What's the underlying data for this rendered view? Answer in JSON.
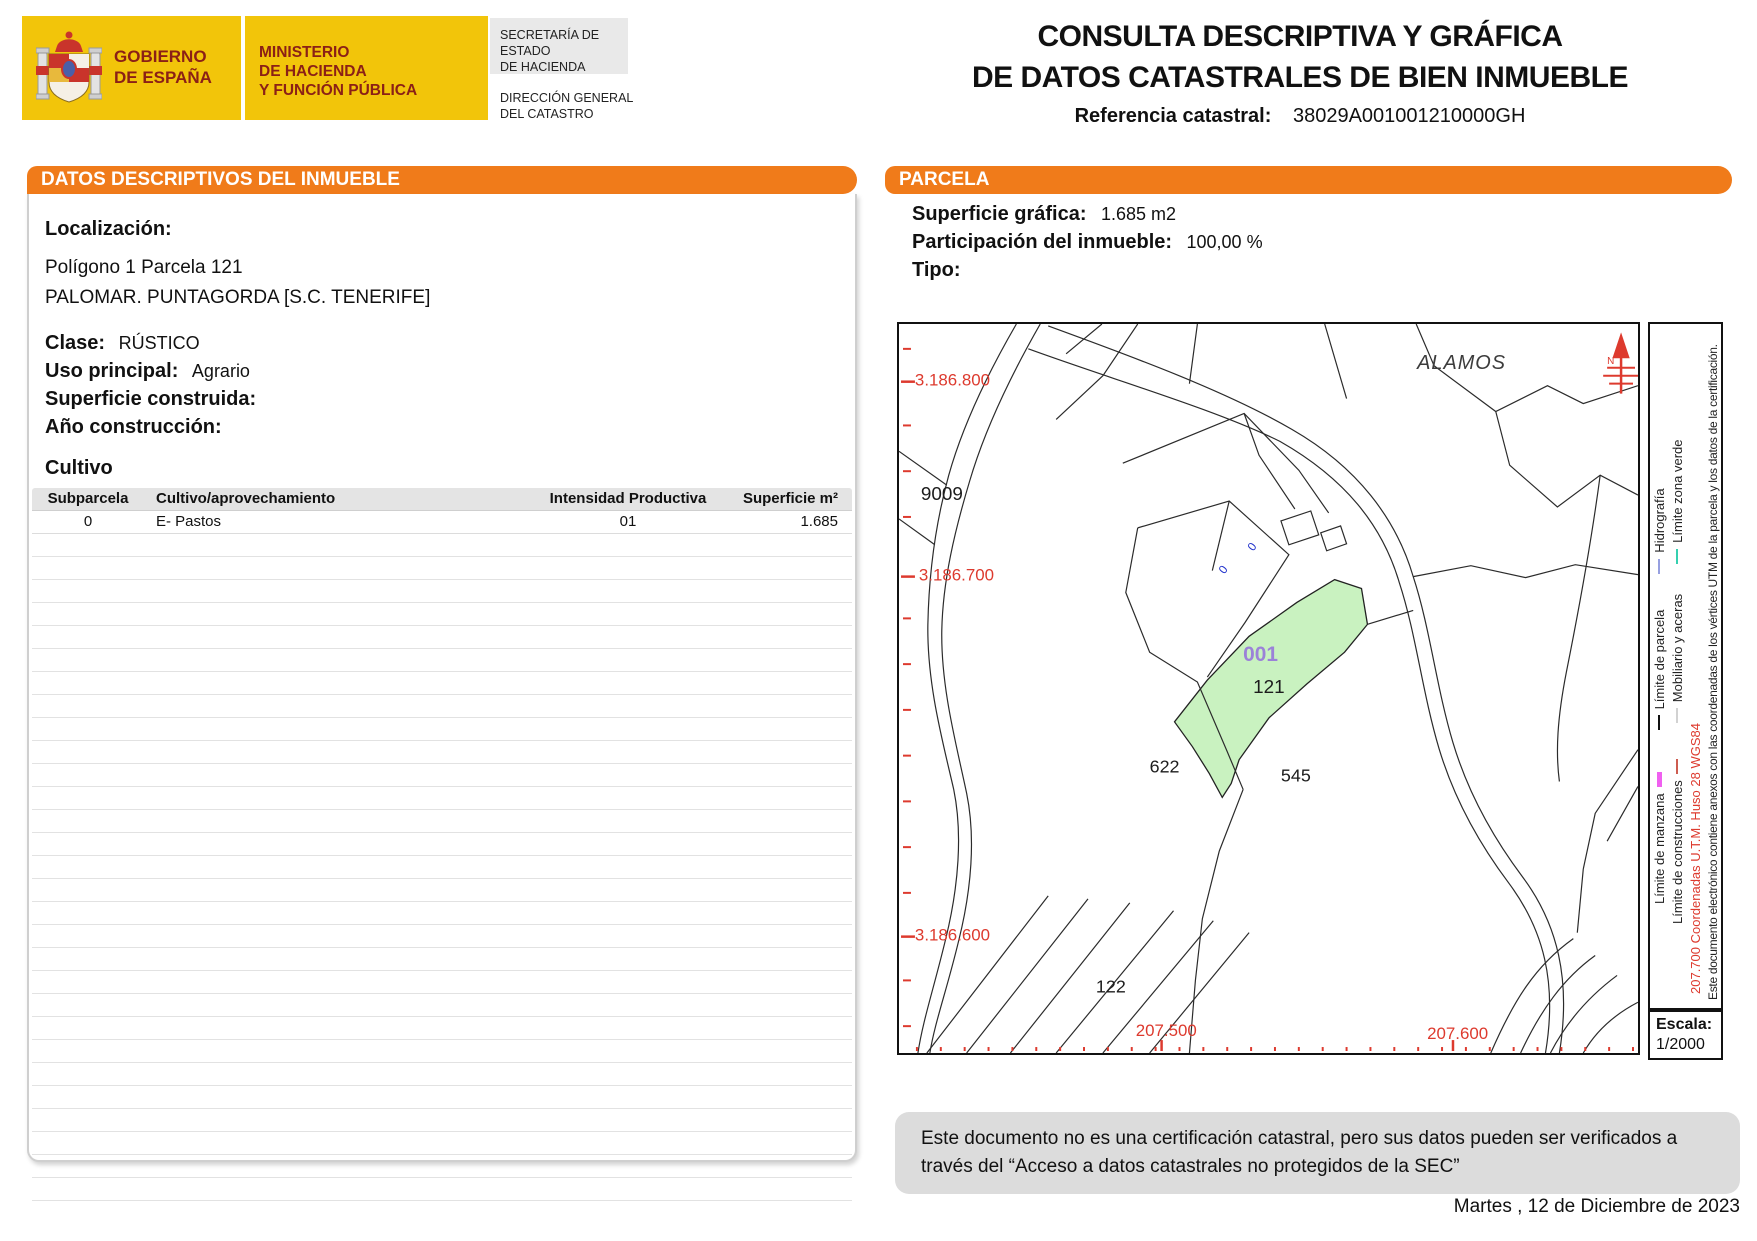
{
  "header": {
    "gobierno_lines": [
      "GOBIERNO",
      "DE ESPAÑA"
    ],
    "ministerio_lines": [
      "MINISTERIO",
      "DE HACIENDA",
      "Y FUNCIÓN PÚBLICA"
    ],
    "secretaria_lines": [
      "SECRETARÍA DE ESTADO",
      "DE HACIENDA"
    ],
    "direccion_lines": [
      "DIRECCIÓN GENERAL",
      "DEL CATASTRO"
    ],
    "title_line1": "CONSULTA DESCRIPTIVA Y GRÁFICA",
    "title_line2": "DE DATOS CATASTRALES DE BIEN INMUEBLE",
    "ref_label": "Referencia catastral:",
    "ref_value": "38029A001001210000GH"
  },
  "left_panel": {
    "section_title_prefix": "DATOS DESCRIPTIVOS DEL ",
    "section_title_bold": "INMUEBLE",
    "localizacion_label": "Localización:",
    "localizacion_line1": "Polígono 1 Parcela 121",
    "localizacion_line2": "PALOMAR. PUNTAGORDA [S.C. TENERIFE]",
    "clase_label": "Clase:",
    "clase_value": "RÚSTICO",
    "uso_label": "Uso principal:",
    "uso_value": "Agrario",
    "superficie_label": "Superficie construida:",
    "anio_label": "Año construcción:",
    "cultivo_title": "Cultivo",
    "table": {
      "headers": [
        "Subparcela",
        "Cultivo/aprovechamiento",
        "Intensidad Productiva",
        "Superficie m²"
      ],
      "rows": [
        [
          "0",
          "E- Pastos",
          "01",
          "1.685"
        ]
      ],
      "empty_row_count": 29
    }
  },
  "right_panel": {
    "section_title": "PARCELA",
    "superficie_grafica_label": "Superficie gráfica:",
    "superficie_grafica_value": "1.685 m2",
    "participacion_label": "Participación del inmueble:",
    "participacion_value": "100,00 %",
    "tipo_label": "Tipo:"
  },
  "map": {
    "place_label": "ALAMOS",
    "y_labels": [
      "3.186.800",
      "3.186.700",
      "3.186.600"
    ],
    "x_labels": [
      "207.500",
      "207.600"
    ],
    "parcel_labels": [
      "9009",
      "122",
      "622",
      "545"
    ],
    "highlight": {
      "subparcela": "001",
      "parcela": "121"
    },
    "building_labels": [
      "0",
      "0"
    ],
    "north_label": "N",
    "scale_label": "Escala:",
    "scale_value": "1/2000"
  },
  "legend": {
    "items_line1": [
      "Límite de manzana",
      "Límite de parcela",
      "Hidrografía"
    ],
    "items_line2": [
      "Límite de construcciones",
      "Mobiliario y aceras",
      "Límite zona verde"
    ],
    "coords_note": "207.700 Coordenadas U.T.M. Huso 28 WGS84",
    "cert_note": "Este documento electrónico contiene anexos con las coordenadas de los vértices UTM de la parcela y los datos de la certificación."
  },
  "footer": {
    "disclaimer": "Este documento no es una certificación catastral, pero sus datos pueden ser verificados a través del “Acceso a datos catastrales no protegidos de la SEC”",
    "date": "Martes , 12 de Diciembre de 2023"
  },
  "colors": {
    "orange": "#f07b1a",
    "banner_yellow": "#f2c50a",
    "logo_maroon": "#8b2016",
    "coord_red": "#dd3a2e",
    "map_green": "#c9f2c0",
    "subparcela_purple": "#9b82d8",
    "label_blue": "#2233cc",
    "hidrografia_blue": "#97a0e0",
    "zona_verde_teal": "#35d0b0",
    "manzana_magenta": "#f060f0",
    "construcciones_red": "#cd5c50",
    "mobiliario_gray": "#d2d2d2",
    "disclaimer_gray": "#dcdcdc"
  }
}
